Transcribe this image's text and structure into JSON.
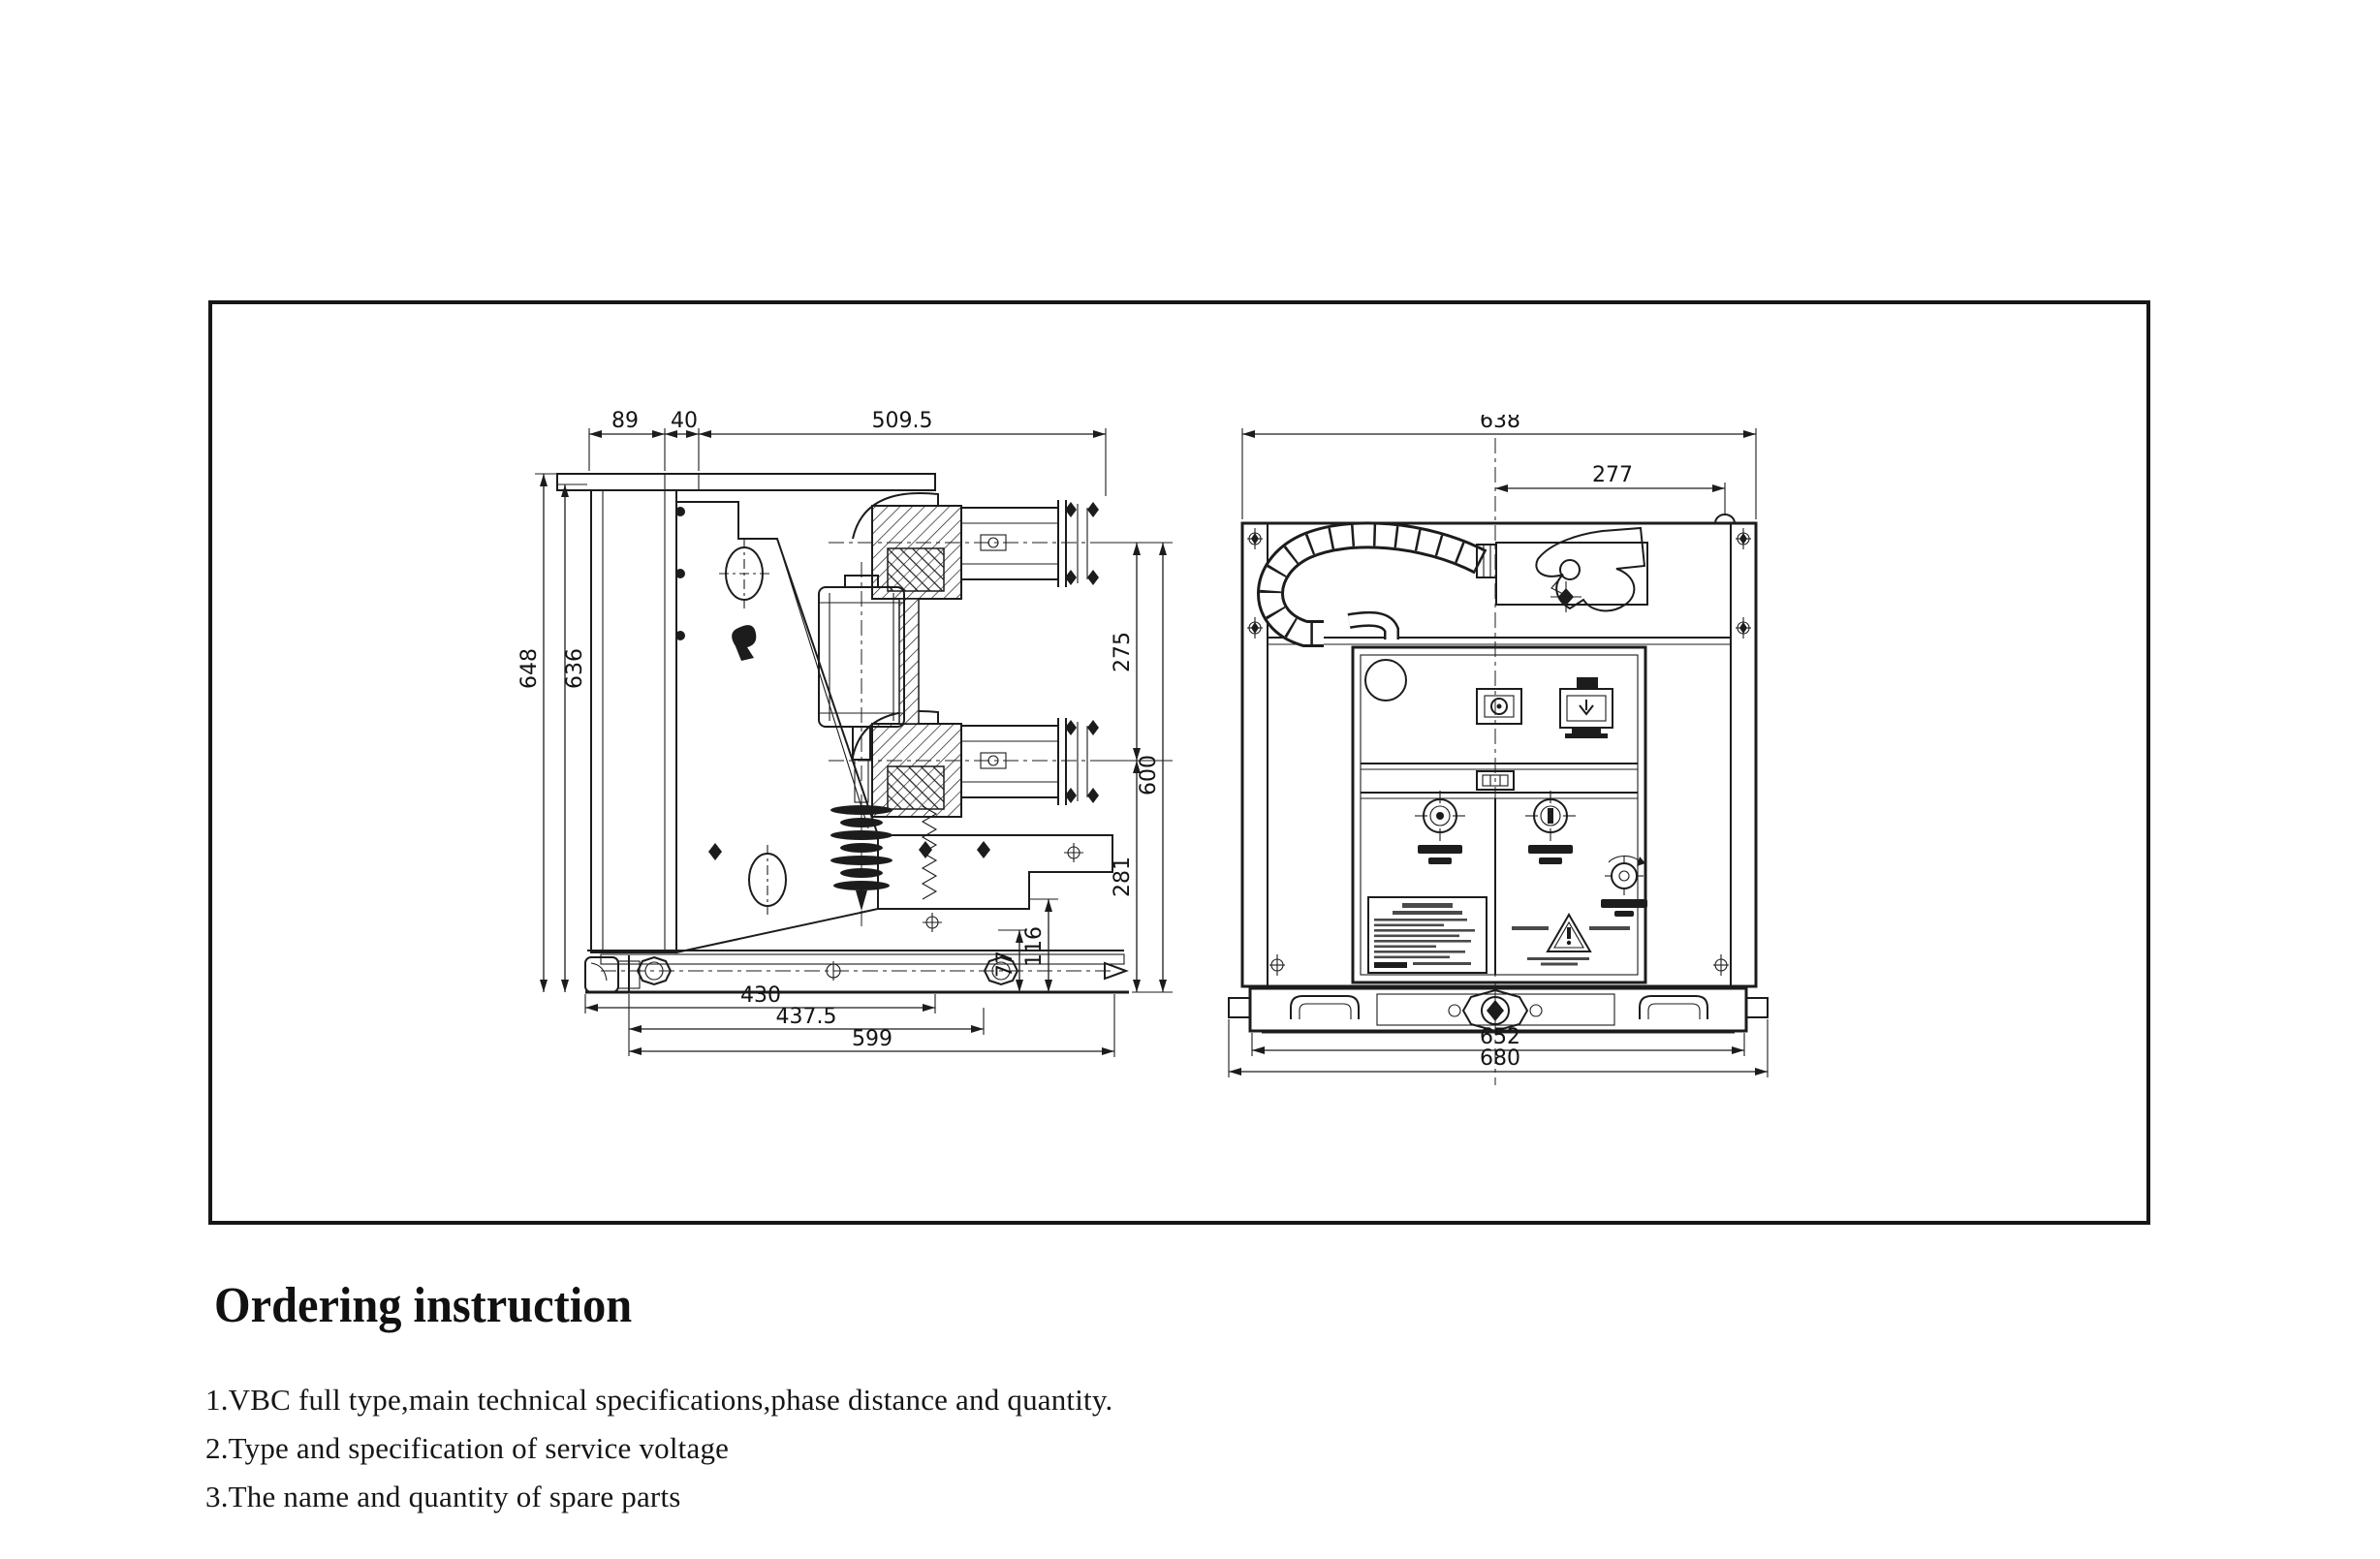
{
  "page": {
    "background": "#ffffff",
    "ink": "#1c1c1c"
  },
  "document": {
    "heading": "Ordering instruction",
    "instructions": [
      "1.VBC full type,main technical specifications,phase distance and quantity.",
      "2.Type and specification of service voltage",
      "3.The name and quantity of spare parts"
    ]
  },
  "side_view": {
    "label": "circuit-breaker-side-view",
    "dims": {
      "d89": "89",
      "d40": "40",
      "d509_5": "509.5",
      "d648": "648",
      "d636": "636",
      "d275": "275",
      "d600": "600",
      "d281": "281",
      "d116": "116",
      "d77": "77",
      "d430": "430",
      "d437_5": "437.5",
      "d599": "599"
    }
  },
  "front_view": {
    "label": "circuit-breaker-front-view",
    "dims": {
      "d638": "638",
      "d277": "277",
      "d652": "652",
      "d680": "680"
    }
  }
}
